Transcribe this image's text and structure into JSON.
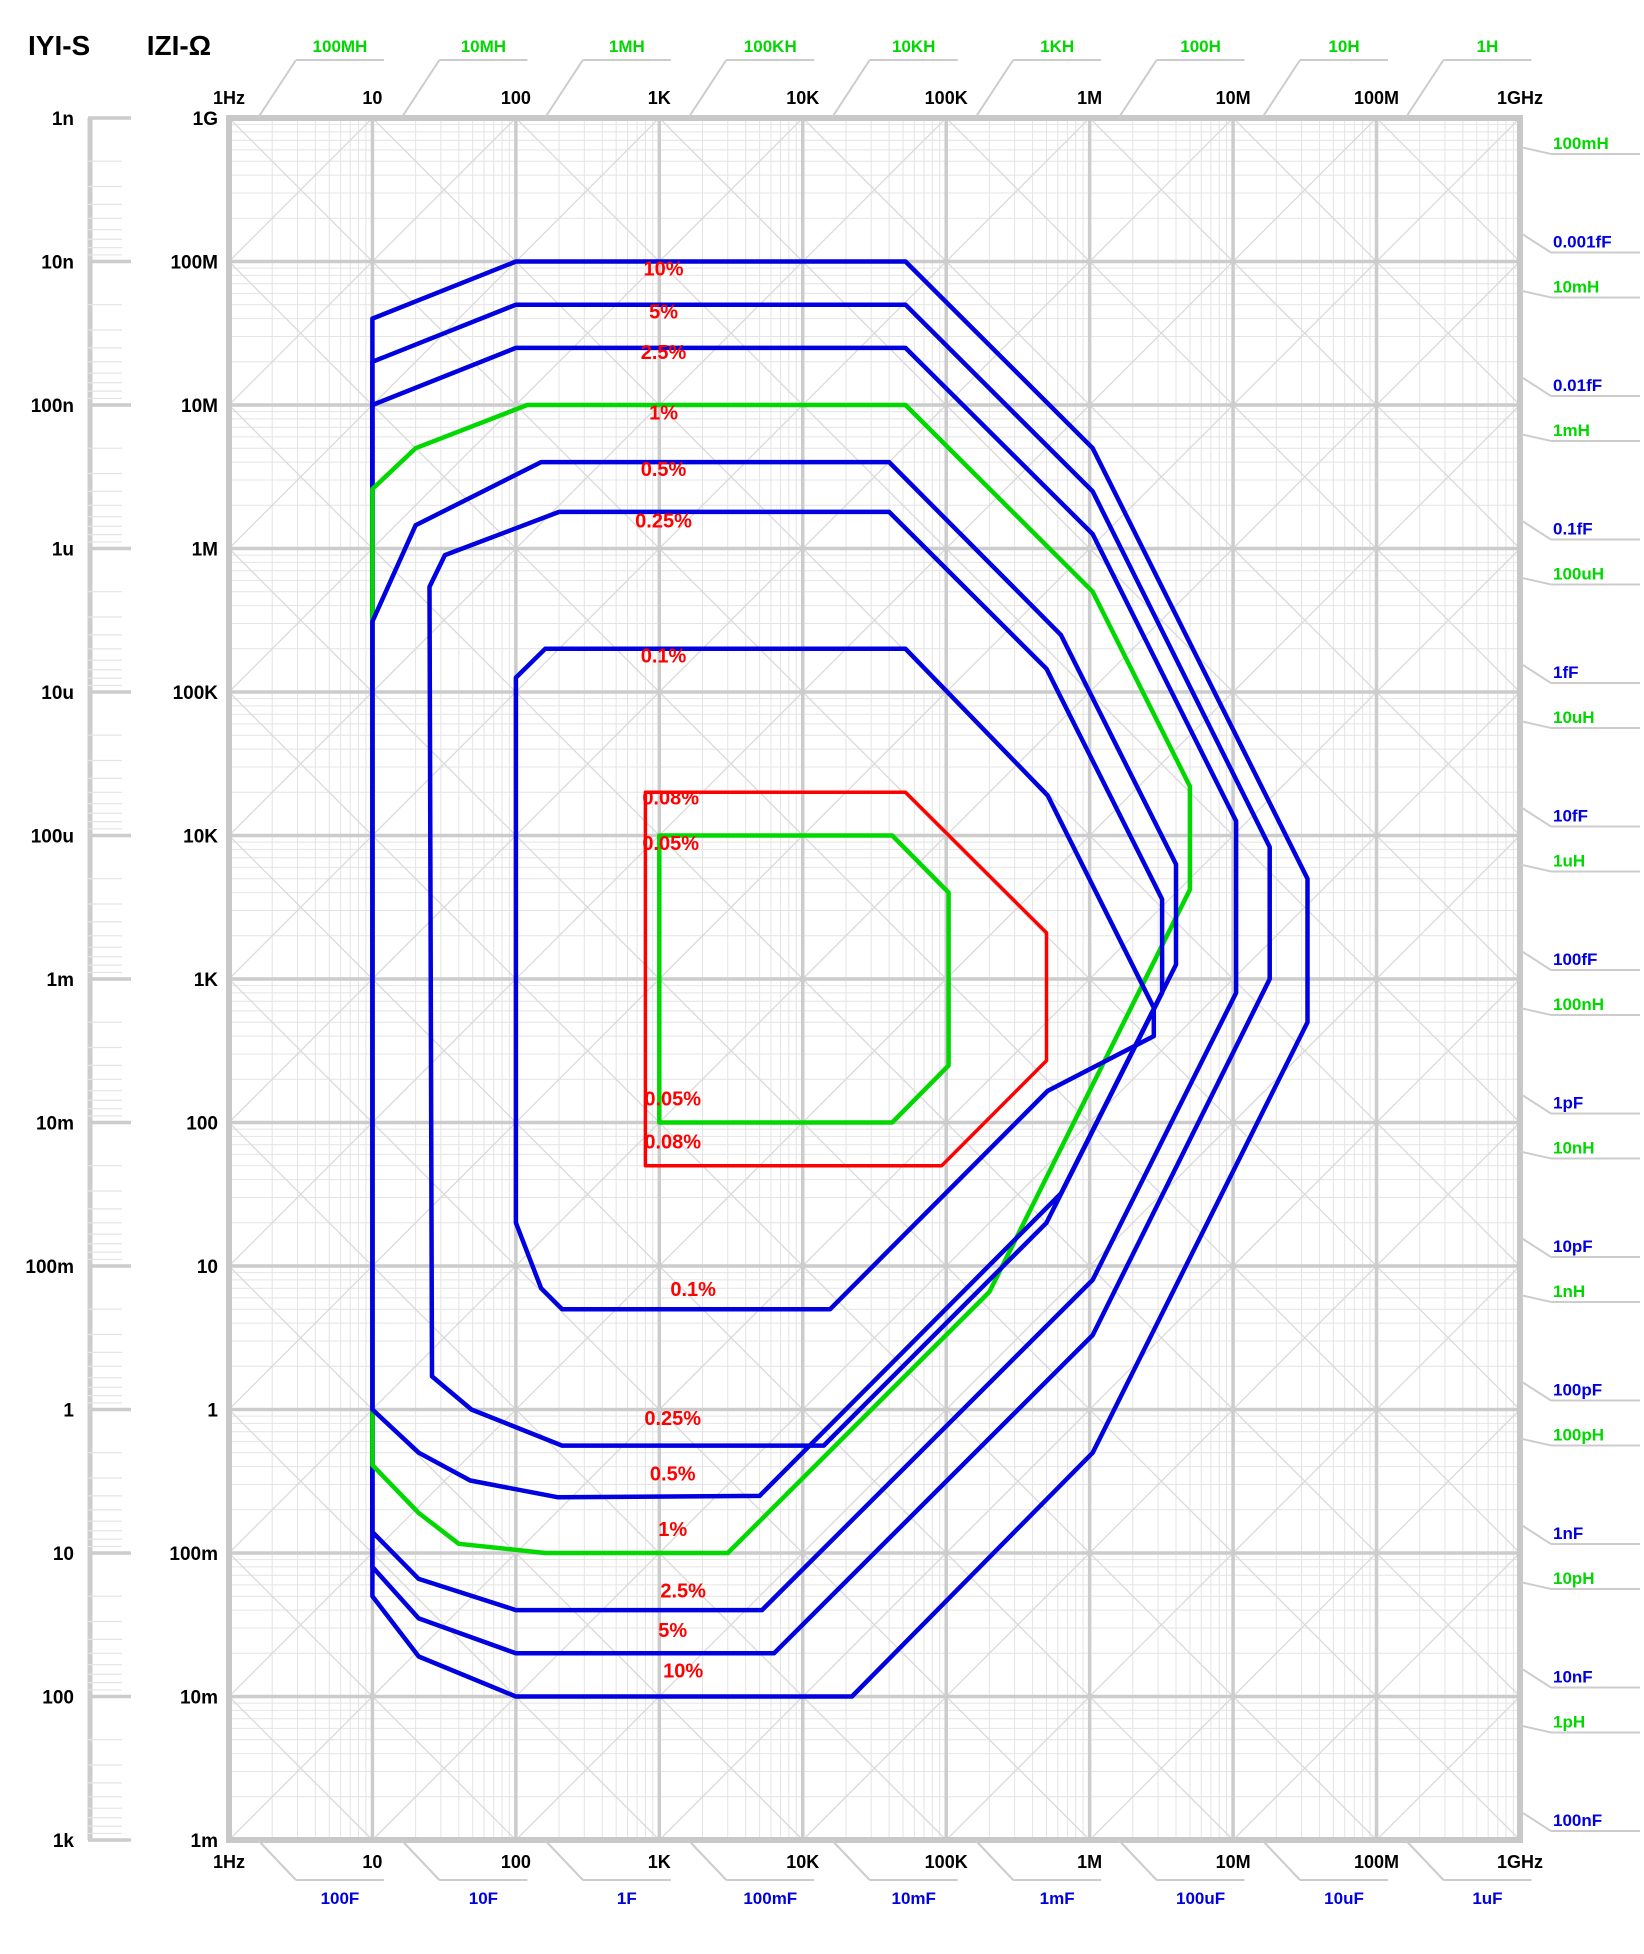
{
  "titles": {
    "admittance": "IYI-S",
    "impedance": "IZI-Ω"
  },
  "colors": {
    "blue": "#0000e0",
    "green": "#00d800",
    "red": "#ff0000",
    "label_red": "#ff0000",
    "grid_major": "#cccccc",
    "grid_minor": "#e4e4e4",
    "grid_diag": "#dadada",
    "border": "#c8c8c8",
    "black": "#000000"
  },
  "chart_data": {
    "type": "line",
    "title": "Impedance measurement accuracy contours",
    "x_axis": {
      "label": "Frequency",
      "log": true,
      "min_hz": 1,
      "max_hz": 1000000000.0,
      "ticks": [
        {
          "f": 1,
          "label": "1Hz"
        },
        {
          "f": 10,
          "label": "10"
        },
        {
          "f": 100,
          "label": "100"
        },
        {
          "f": 1000,
          "label": "1K"
        },
        {
          "f": 10000,
          "label": "10K"
        },
        {
          "f": 100000,
          "label": "100K"
        },
        {
          "f": 1000000,
          "label": "1M"
        },
        {
          "f": 10000000,
          "label": "10M"
        },
        {
          "f": 100000000,
          "label": "100M"
        },
        {
          "f": 1000000000,
          "label": "1GHz"
        }
      ]
    },
    "z_axis": {
      "label": "IZI-Ω",
      "log": true,
      "min_ohm": 0.001,
      "max_ohm": 1000000000.0,
      "ticks": [
        "1G",
        "100M",
        "10M",
        "1M",
        "100K",
        "10K",
        "1K",
        "100",
        "10",
        "1",
        "100m",
        "10m",
        "1m"
      ]
    },
    "y_axis_siemens": {
      "label": "IYI-S",
      "log": true,
      "ticks": [
        "1n",
        "10n",
        "100n",
        "1u",
        "10u",
        "100u",
        "1m",
        "10m",
        "100m",
        "1",
        "10",
        "100",
        "1k"
      ]
    },
    "inductance_labels_top": [
      {
        "label": "100MH",
        "henry": 100000000.0
      },
      {
        "label": "10MH",
        "henry": 10000000.0
      },
      {
        "label": "1MH",
        "henry": 1000000.0
      },
      {
        "label": "100KH",
        "henry": 100000.0
      },
      {
        "label": "10KH",
        "henry": 10000.0
      },
      {
        "label": "1KH",
        "henry": 1000.0
      },
      {
        "label": "100H",
        "henry": 100
      },
      {
        "label": "10H",
        "henry": 10
      },
      {
        "label": "1H",
        "henry": 1
      }
    ],
    "inductance_labels_right": [
      {
        "label": "100mH",
        "henry": 0.1
      },
      {
        "label": "10mH",
        "henry": 0.01
      },
      {
        "label": "1mH",
        "henry": 0.001
      },
      {
        "label": "100uH",
        "henry": 0.0001
      },
      {
        "label": "10uH",
        "henry": 1e-05
      },
      {
        "label": "1uH",
        "henry": 1e-06
      },
      {
        "label": "100nH",
        "henry": 1e-07
      },
      {
        "label": "10nH",
        "henry": 1e-08
      },
      {
        "label": "1nH",
        "henry": 1e-09
      },
      {
        "label": "100pH",
        "henry": 1e-10
      },
      {
        "label": "10pH",
        "henry": 1e-11
      },
      {
        "label": "1pH",
        "henry": 1e-12
      }
    ],
    "capacitance_labels_right": [
      {
        "label": "0.001fF",
        "farad": 1e-18
      },
      {
        "label": "0.01fF",
        "farad": 1e-17
      },
      {
        "label": "0.1fF",
        "farad": 1e-16
      },
      {
        "label": "1fF",
        "farad": 1e-15
      },
      {
        "label": "10fF",
        "farad": 1e-14
      },
      {
        "label": "100fF",
        "farad": 1e-13
      },
      {
        "label": "1pF",
        "farad": 1e-12
      },
      {
        "label": "10pF",
        "farad": 1e-11
      },
      {
        "label": "100pF",
        "farad": 1e-10
      },
      {
        "label": "1nF",
        "farad": 1e-09
      },
      {
        "label": "10nF",
        "farad": 1e-08
      },
      {
        "label": "100nF",
        "farad": 1e-07
      }
    ],
    "capacitance_labels_bottom": [
      {
        "label": "100F",
        "farad": 100
      },
      {
        "label": "10F",
        "farad": 10
      },
      {
        "label": "1F",
        "farad": 1
      },
      {
        "label": "100mF",
        "farad": 0.1
      },
      {
        "label": "10mF",
        "farad": 0.01
      },
      {
        "label": "1mF",
        "farad": 0.001
      },
      {
        "label": "100uF",
        "farad": 0.0001
      },
      {
        "label": "10uF",
        "farad": 1e-05
      },
      {
        "label": "1uF",
        "farad": 1e-06
      }
    ],
    "series": [
      {
        "name": "10%",
        "color": "blue",
        "points": [
          [
            10,
            40000000.0
          ],
          [
            100,
            100000000.0
          ],
          [
            52000.0,
            100000000.0
          ],
          [
            1050000.0,
            5000000.0
          ],
          [
            33000000.0,
            5000
          ],
          [
            33000000.0,
            500
          ],
          [
            1050000.0,
            0.5
          ],
          [
            22000.0,
            0.01
          ],
          [
            100,
            0.01
          ],
          [
            21,
            0.019
          ],
          [
            10,
            0.05
          ]
        ]
      },
      {
        "name": "5%",
        "color": "blue",
        "points": [
          [
            10,
            20000000.0
          ],
          [
            100,
            50000000.0
          ],
          [
            52000.0,
            50000000.0
          ],
          [
            1050000.0,
            2500000.0
          ],
          [
            18000000.0,
            8300
          ],
          [
            18000000.0,
            1000
          ],
          [
            1050000.0,
            3.3
          ],
          [
            6300,
            0.02
          ],
          [
            100,
            0.02
          ],
          [
            21,
            0.035
          ],
          [
            10,
            0.08
          ]
        ]
      },
      {
        "name": "2.5%",
        "color": "blue",
        "points": [
          [
            10,
            10000000.0
          ],
          [
            100,
            25000000.0
          ],
          [
            52000.0,
            25000000.0
          ],
          [
            1050000.0,
            1260000.0
          ],
          [
            10500000.0,
            12600
          ],
          [
            10500000.0,
            800
          ],
          [
            1050000.0,
            8
          ],
          [
            5200,
            0.04
          ],
          [
            100,
            0.04
          ],
          [
            21,
            0.066
          ],
          [
            10,
            0.14
          ]
        ]
      },
      {
        "name": "1%",
        "color": "green",
        "points": [
          [
            10,
            2600000.0
          ],
          [
            20,
            5000000.0
          ],
          [
            120,
            10000000.0
          ],
          [
            52000.0,
            10000000.0
          ],
          [
            1050000.0,
            500000.0
          ],
          [
            5000000.0,
            22000
          ],
          [
            5000000.0,
            4200
          ],
          [
            200000.0,
            6.6
          ],
          [
            3000,
            0.1
          ],
          [
            160,
            0.1
          ],
          [
            40,
            0.116
          ],
          [
            21,
            0.19
          ],
          [
            10,
            0.41
          ]
        ]
      },
      {
        "name": "0.5%",
        "color": "blue",
        "points": [
          [
            10,
            310000.0
          ],
          [
            20,
            1450000.0
          ],
          [
            150,
            4000000.0
          ],
          [
            40000.0,
            4000000.0
          ],
          [
            630000.0,
            250000.0
          ],
          [
            4000000.0,
            6300
          ],
          [
            4000000.0,
            1260
          ],
          [
            630000.0,
            32
          ],
          [
            5000,
            0.25
          ],
          [
            195,
            0.245
          ],
          [
            48,
            0.32
          ],
          [
            21,
            0.5
          ],
          [
            10,
            1.0
          ]
        ]
      },
      {
        "name": "0.25%",
        "color": "blue",
        "points": [
          [
            25,
            540000.0
          ],
          [
            32,
            900000.0
          ],
          [
            200,
            1800000.0
          ],
          [
            40000.0,
            1800000.0
          ],
          [
            500000.0,
            145000.0
          ],
          [
            3200000.0,
            3600
          ],
          [
            3200000.0,
            800
          ],
          [
            500000.0,
            20
          ],
          [
            14000.0,
            0.56
          ],
          [
            210,
            0.56
          ],
          [
            49,
            1.0
          ],
          [
            26,
            1.7
          ]
        ]
      },
      {
        "name": "0.1%",
        "color": "blue",
        "points": [
          [
            100,
            126000.0
          ],
          [
            160,
            200000.0
          ],
          [
            52000.0,
            200000.0
          ],
          [
            510000.0,
            19000.0
          ],
          [
            2800000.0,
            630
          ],
          [
            2800000.0,
            400
          ],
          [
            510000.0,
            166
          ],
          [
            15500.0,
            5
          ],
          [
            210,
            5
          ],
          [
            150,
            7
          ],
          [
            100,
            20
          ]
        ]
      },
      {
        "name": "0.08%",
        "color": "red",
        "points": [
          [
            800,
            20000.0
          ],
          [
            52000.0,
            20000.0
          ],
          [
            500000.0,
            2100
          ],
          [
            500000.0,
            270
          ],
          [
            93000.0,
            50
          ],
          [
            800,
            50
          ]
        ]
      },
      {
        "name": "0.05%",
        "color": "green",
        "points": [
          [
            1000,
            10000.0
          ],
          [
            42000.0,
            10000.0
          ],
          [
            104000.0,
            4000
          ],
          [
            104000.0,
            250
          ],
          [
            42000.0,
            100
          ],
          [
            1000,
            100
          ]
        ]
      }
    ],
    "annotations": [
      {
        "text": "10%",
        "f": 1070,
        "z": 80000000.0
      },
      {
        "text": "5%",
        "f": 1070,
        "z": 40000000.0
      },
      {
        "text": "2.5%",
        "f": 1070,
        "z": 21000000.0
      },
      {
        "text": "1%",
        "f": 1070,
        "z": 7900000.0
      },
      {
        "text": "0.5%",
        "f": 1070,
        "z": 3200000.0
      },
      {
        "text": "0.25%",
        "f": 1070,
        "z": 1400000.0
      },
      {
        "text": "0.1%",
        "f": 1070,
        "z": 160000.0
      },
      {
        "text": "0.08%",
        "f": 1200,
        "z": 16400.0
      },
      {
        "text": "0.05%",
        "f": 1200,
        "z": 7900
      },
      {
        "text": "0.05%",
        "f": 1240,
        "z": 131
      },
      {
        "text": "0.08%",
        "f": 1240,
        "z": 66
      },
      {
        "text": "0.1%",
        "f": 1722,
        "z": 6.2
      },
      {
        "text": "0.25%",
        "f": 1240,
        "z": 0.78
      },
      {
        "text": "0.5%",
        "f": 1240,
        "z": 0.32
      },
      {
        "text": "1%",
        "f": 1240,
        "z": 0.131
      },
      {
        "text": "2.5%",
        "f": 1466,
        "z": 0.049
      },
      {
        "text": "5%",
        "f": 1240,
        "z": 0.026
      },
      {
        "text": "10%",
        "f": 1466,
        "z": 0.0136
      }
    ]
  }
}
